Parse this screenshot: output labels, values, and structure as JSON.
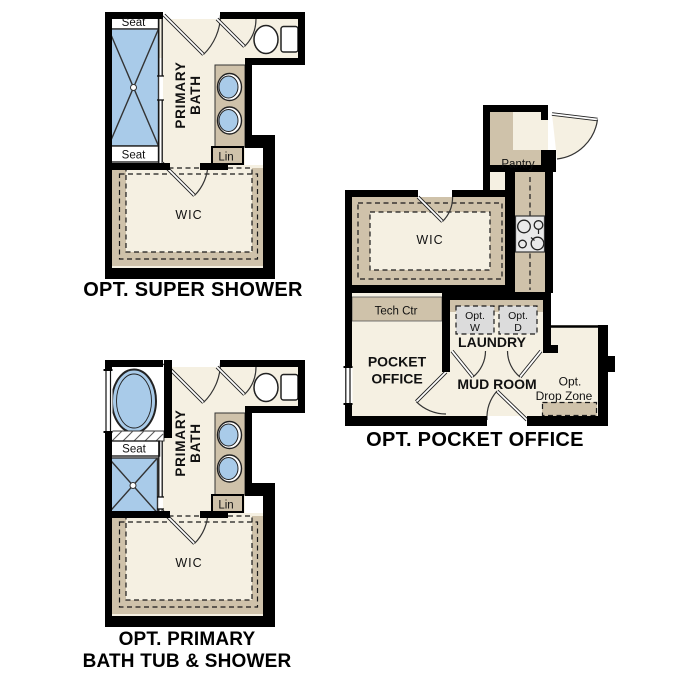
{
  "plans": {
    "super_shower": {
      "title": "OPT. SUPER SHOWER",
      "seat_top": "Seat",
      "seat_bottom": "Seat",
      "primary_line1": "PRIMARY",
      "primary_line2": "BATH",
      "lin": "Lin",
      "wic": "WIC"
    },
    "tub_shower": {
      "title_line1": "OPT. PRIMARY",
      "title_line2": "BATH TUB & SHOWER",
      "seat": "Seat",
      "primary_line1": "PRIMARY",
      "primary_line2": "BATH",
      "lin": "Lin",
      "wic": "WIC"
    },
    "pocket_office": {
      "title": "OPT. POCKET OFFICE",
      "pantry": "Pantry",
      "wic": "WIC",
      "tech_ctr": "Tech Ctr",
      "office_line1": "POCKET",
      "office_line2": "OFFICE",
      "laundry": "LAUNDRY",
      "mud_room": "MUD ROOM",
      "washer_line1": "Opt.",
      "washer_line2": "W",
      "dryer_line1": "Opt.",
      "dryer_line2": "D",
      "drop_line1": "Opt.",
      "drop_line2": "Drop Zone"
    }
  },
  "colors": {
    "wall": "#000000",
    "floor": "#f5f0e2",
    "cabinetry_tan": "#cfc2aa",
    "fixture_blue": "#a9cbe9",
    "appliance_gray": "#dcdcdc",
    "cooktop_gray": "#e9e9e9"
  }
}
